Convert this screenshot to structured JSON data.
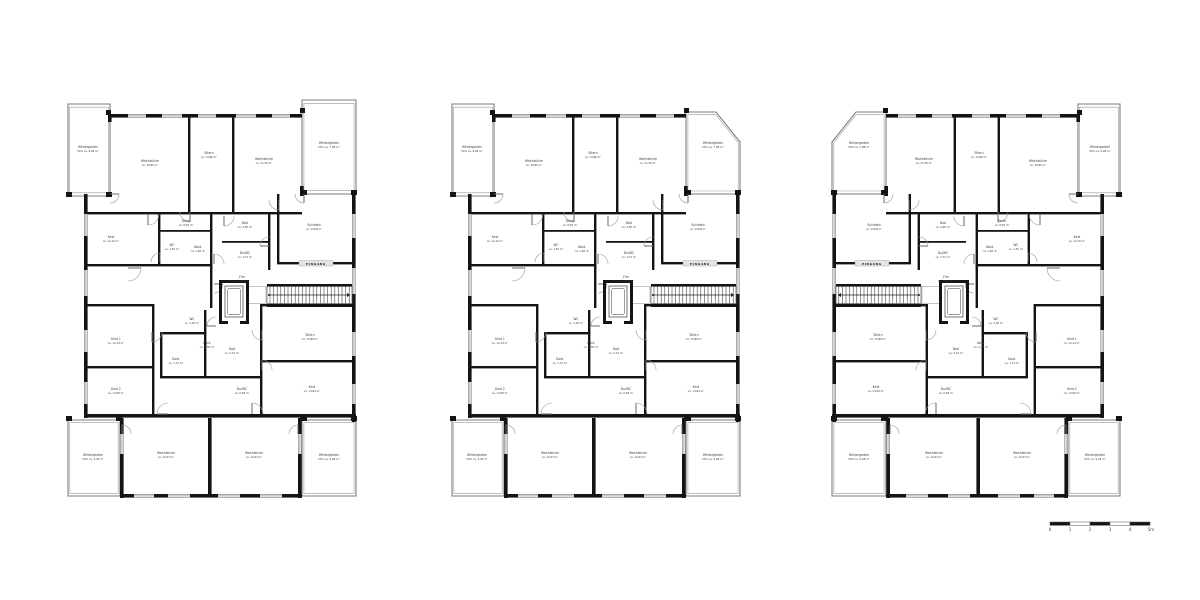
{
  "page": {
    "background_color": "#ffffff",
    "wall_color": "#141414",
    "line_color": "#8a8a8a",
    "label_color": "#3c3c3c"
  },
  "annotations": {
    "entrance_label": "EINGANG"
  },
  "scale_bar": {
    "tick_labels": [
      "0",
      "1",
      "2",
      "3",
      "4",
      "5m"
    ]
  },
  "plans": [
    {
      "id": "floor-plan-left",
      "variant": "rect-wintergartens",
      "mirrored": false,
      "rooms": {
        "wg_tl": {
          "name": "Wintergarten",
          "area": "50% ca. 9,68 m²"
        },
        "wohnkueche_1": {
          "name": "Wohnküche",
          "area": "ca. 20,86 m²"
        },
        "eltern": {
          "name": "Eltern",
          "area": "ca. 14,86 m²"
        },
        "wohnzimmer": {
          "name": "Wohnküche",
          "area": "ca. 21,36 m²"
        },
        "wg_tr": {
          "name": "Wintergarten",
          "area": "50% ca. 7,88 m²"
        },
        "kind_l": {
          "name": "Kind",
          "area": "ca. 12,16 m²"
        },
        "diele_1": {
          "name": "Diele",
          "area": "ca. 8,95 m²"
        },
        "wc_1": {
          "name": "WC",
          "area": "ca. 1,55 m²"
        },
        "abstell_1": {
          "name": "Abst.",
          "area": "ca. 1,98 m²"
        },
        "bad_1": {
          "name": "Bad",
          "area": "ca. 4,85 m²"
        },
        "dusche_wc_1": {
          "name": "Du/WC",
          "area": "ca. 3,74 m²"
        },
        "schlafen": {
          "name": "Schlafen",
          "area": "ca. 14,06 m²"
        },
        "flur": {
          "name": "Flur",
          "area": "ca. 20,02 m²"
        },
        "kind_1": {
          "name": "Kind 1",
          "area": "ca. 12,14 m²"
        },
        "kind_2": {
          "name": "Kind 2",
          "area": "ca. 13,68 m²"
        },
        "garderobe": {
          "name": "Gard.",
          "area": "ca. 7,13 m²"
        },
        "wc_2": {
          "name": "WC",
          "area": "ca. 2,28 m²"
        },
        "abstell_2": {
          "name": "Abst.",
          "area": "ca. 2,38 m²"
        },
        "bad_2": {
          "name": "Bad",
          "area": "ca. 5,23 m²"
        },
        "dusche_wc_2": {
          "name": "Du/WC",
          "area": "ca. 6,28 m²"
        },
        "eltern_2": {
          "name": "Eltern",
          "area": "ca. 13,88 m²"
        },
        "kind_3": {
          "name": "Kind",
          "area": "ca. 14,84 m²"
        },
        "wohnkueche_2": {
          "name": "Wohnküche",
          "area": "ca. 24,33 m²"
        },
        "wohnkueche_3": {
          "name": "Wohnküche",
          "area": "ca. 24,92 m²"
        },
        "wg_bl": {
          "name": "Wintergarten",
          "area": "50% ca. 9,26 m²"
        },
        "wg_br": {
          "name": "Wintergarten",
          "area": "50% ca. 9,68 m²"
        }
      }
    },
    {
      "id": "floor-plan-middle",
      "variant": "chamfer-top-right",
      "mirrored": false,
      "rooms": {
        "wg_tl": {
          "name": "Wintergarten",
          "area": "50% ca. 9,68 m²"
        },
        "wohnkueche_1": {
          "name": "Wohnküche",
          "area": "ca. 20,86 m²"
        },
        "eltern": {
          "name": "Eltern",
          "area": "ca. 14,86 m²"
        },
        "wohnzimmer": {
          "name": "Wohnküche",
          "area": "ca. 21,36 m²"
        },
        "wg_tr": {
          "name": "Wintergarten",
          "area": "50% ca. 7,88 m²"
        },
        "kind_l": {
          "name": "Kind",
          "area": "ca. 12,16 m²"
        },
        "diele_1": {
          "name": "Diele",
          "area": "ca. 8,95 m²"
        },
        "wc_1": {
          "name": "WC",
          "area": "ca. 1,55 m²"
        },
        "abstell_1": {
          "name": "Abst.",
          "area": "ca. 1,98 m²"
        },
        "bad_1": {
          "name": "Bad",
          "area": "ca. 4,85 m²"
        },
        "dusche_wc_1": {
          "name": "Du/WC",
          "area": "ca. 3,74 m²"
        },
        "schlafen": {
          "name": "Schlafen",
          "area": "ca. 14,06 m²"
        },
        "flur": {
          "name": "Flur",
          "area": "ca. 20,02 m²"
        },
        "kind_1": {
          "name": "Kind 1",
          "area": "ca. 12,14 m²"
        },
        "kind_2": {
          "name": "Kind 2",
          "area": "ca. 13,68 m²"
        },
        "garderobe": {
          "name": "Gard.",
          "area": "ca. 7,13 m²"
        },
        "wc_2": {
          "name": "WC",
          "area": "ca. 2,28 m²"
        },
        "abstell_2": {
          "name": "Abst.",
          "area": "ca. 2,38 m²"
        },
        "bad_2": {
          "name": "Bad",
          "area": "ca. 5,23 m²"
        },
        "dusche_wc_2": {
          "name": "Du/WC",
          "area": "ca. 6,28 m²"
        },
        "eltern_2": {
          "name": "Eltern",
          "area": "ca. 13,88 m²"
        },
        "kind_3": {
          "name": "Kind",
          "area": "ca. 14,84 m²"
        },
        "wohnkueche_2": {
          "name": "Wohnküche",
          "area": "ca. 24,33 m²"
        },
        "wohnkueche_3": {
          "name": "Wohnküche",
          "area": "ca. 24,92 m²"
        },
        "wg_bl": {
          "name": "Wintergarten",
          "area": "50% ca. 9,26 m²"
        },
        "wg_br": {
          "name": "Wintergarten",
          "area": "50% ca. 9,68 m²"
        }
      }
    },
    {
      "id": "floor-plan-right",
      "variant": "chamfer-top-left",
      "mirrored": true,
      "rooms": {
        "wg_tl": {
          "name": "Wintergarten",
          "area": "50% ca. 9,68 m²"
        },
        "wohnkueche_1": {
          "name": "Wohnküche",
          "area": "ca. 20,86 m²"
        },
        "eltern": {
          "name": "Eltern",
          "area": "ca. 14,86 m²"
        },
        "wohnzimmer": {
          "name": "Wohnküche",
          "area": "ca. 21,36 m²"
        },
        "wg_tr": {
          "name": "Wintergarten",
          "area": "50% ca. 7,88 m²"
        },
        "kind_l": {
          "name": "Kind",
          "area": "ca. 12,16 m²"
        },
        "diele_1": {
          "name": "Diele",
          "area": "ca. 8,95 m²"
        },
        "wc_1": {
          "name": "WC",
          "area": "ca. 1,55 m²"
        },
        "abstell_1": {
          "name": "Abst.",
          "area": "ca. 1,98 m²"
        },
        "bad_1": {
          "name": "Bad",
          "area": "ca. 4,85 m²"
        },
        "dusche_wc_1": {
          "name": "Du/WC",
          "area": "ca. 3,74 m²"
        },
        "schlafen": {
          "name": "Schlafen",
          "area": "ca. 14,06 m²"
        },
        "flur": {
          "name": "Flur",
          "area": "ca. 20,02 m²"
        },
        "kind_1": {
          "name": "Kind 1",
          "area": "ca. 12,14 m²"
        },
        "kind_2": {
          "name": "Kind 2",
          "area": "ca. 13,68 m²"
        },
        "garderobe": {
          "name": "Gard.",
          "area": "ca. 7,13 m²"
        },
        "wc_2": {
          "name": "WC",
          "area": "ca. 2,28 m²"
        },
        "abstell_2": {
          "name": "Abst.",
          "area": "ca. 2,38 m²"
        },
        "bad_2": {
          "name": "Bad",
          "area": "ca. 5,23 m²"
        },
        "dusche_wc_2": {
          "name": "Du/WC",
          "area": "ca. 6,28 m²"
        },
        "eltern_2": {
          "name": "Eltern",
          "area": "ca. 13,88 m²"
        },
        "kind_3": {
          "name": "Kind",
          "area": "ca. 14,84 m²"
        },
        "wohnkueche_2": {
          "name": "Wohnküche",
          "area": "ca. 24,33 m²"
        },
        "wohnkueche_3": {
          "name": "Wohnküche",
          "area": "ca. 24,92 m²"
        },
        "wg_bl": {
          "name": "Wintergarten",
          "area": "50% ca. 9,26 m²"
        },
        "wg_br": {
          "name": "Wintergarten",
          "area": "50% ca. 9,68 m²"
        }
      }
    }
  ]
}
